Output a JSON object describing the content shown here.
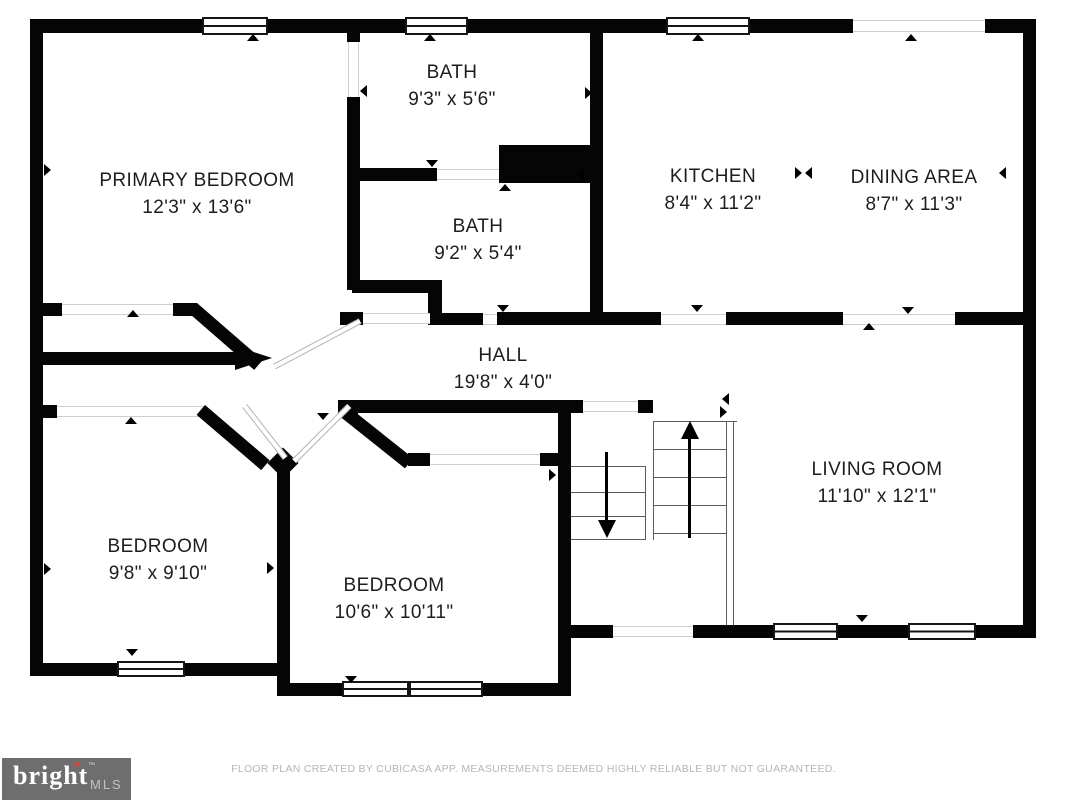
{
  "colors": {
    "wall": "#050505",
    "label_text": "#1d1d1d",
    "opening_line": "#cfcfcf",
    "stair_line": "#5a5a5a",
    "disclaimer_text": "#b6b6b6",
    "logo_background": "#6e6e6e",
    "logo_brand_text": "#ffffff",
    "logo_star": "#cf4a3e",
    "logo_mls_text": "#c2c2c2"
  },
  "rooms": [
    {
      "name": "PRIMARY BEDROOM",
      "dims": "12'3\" x 13'6\""
    },
    {
      "name": "BATH",
      "dims": "9'3\" x 5'6\""
    },
    {
      "name": "BATH",
      "dims": "9'2\" x 5'4\""
    },
    {
      "name": "KITCHEN",
      "dims": "8'4\" x 11'2\""
    },
    {
      "name": "DINING AREA",
      "dims": "8'7\" x 11'3\""
    },
    {
      "name": "HALL",
      "dims": "19'8\" x 4'0\""
    },
    {
      "name": "BEDROOM",
      "dims": "9'8\" x 9'10\""
    },
    {
      "name": "BEDROOM",
      "dims": "10'6\" x 10'11\""
    },
    {
      "name": "LIVING ROOM",
      "dims": "11'10\" x 12'1\""
    }
  ],
  "footer": {
    "disclaimer": "FLOOR PLAN CREATED BY CUBICASA APP. MEASUREMENTS DEEMED HIGHLY RELIABLE BUT NOT GUARANTEED."
  },
  "logo": {
    "brand": "bright",
    "star_glyph": "✦",
    "tm": "™",
    "suffix": "MLS"
  }
}
